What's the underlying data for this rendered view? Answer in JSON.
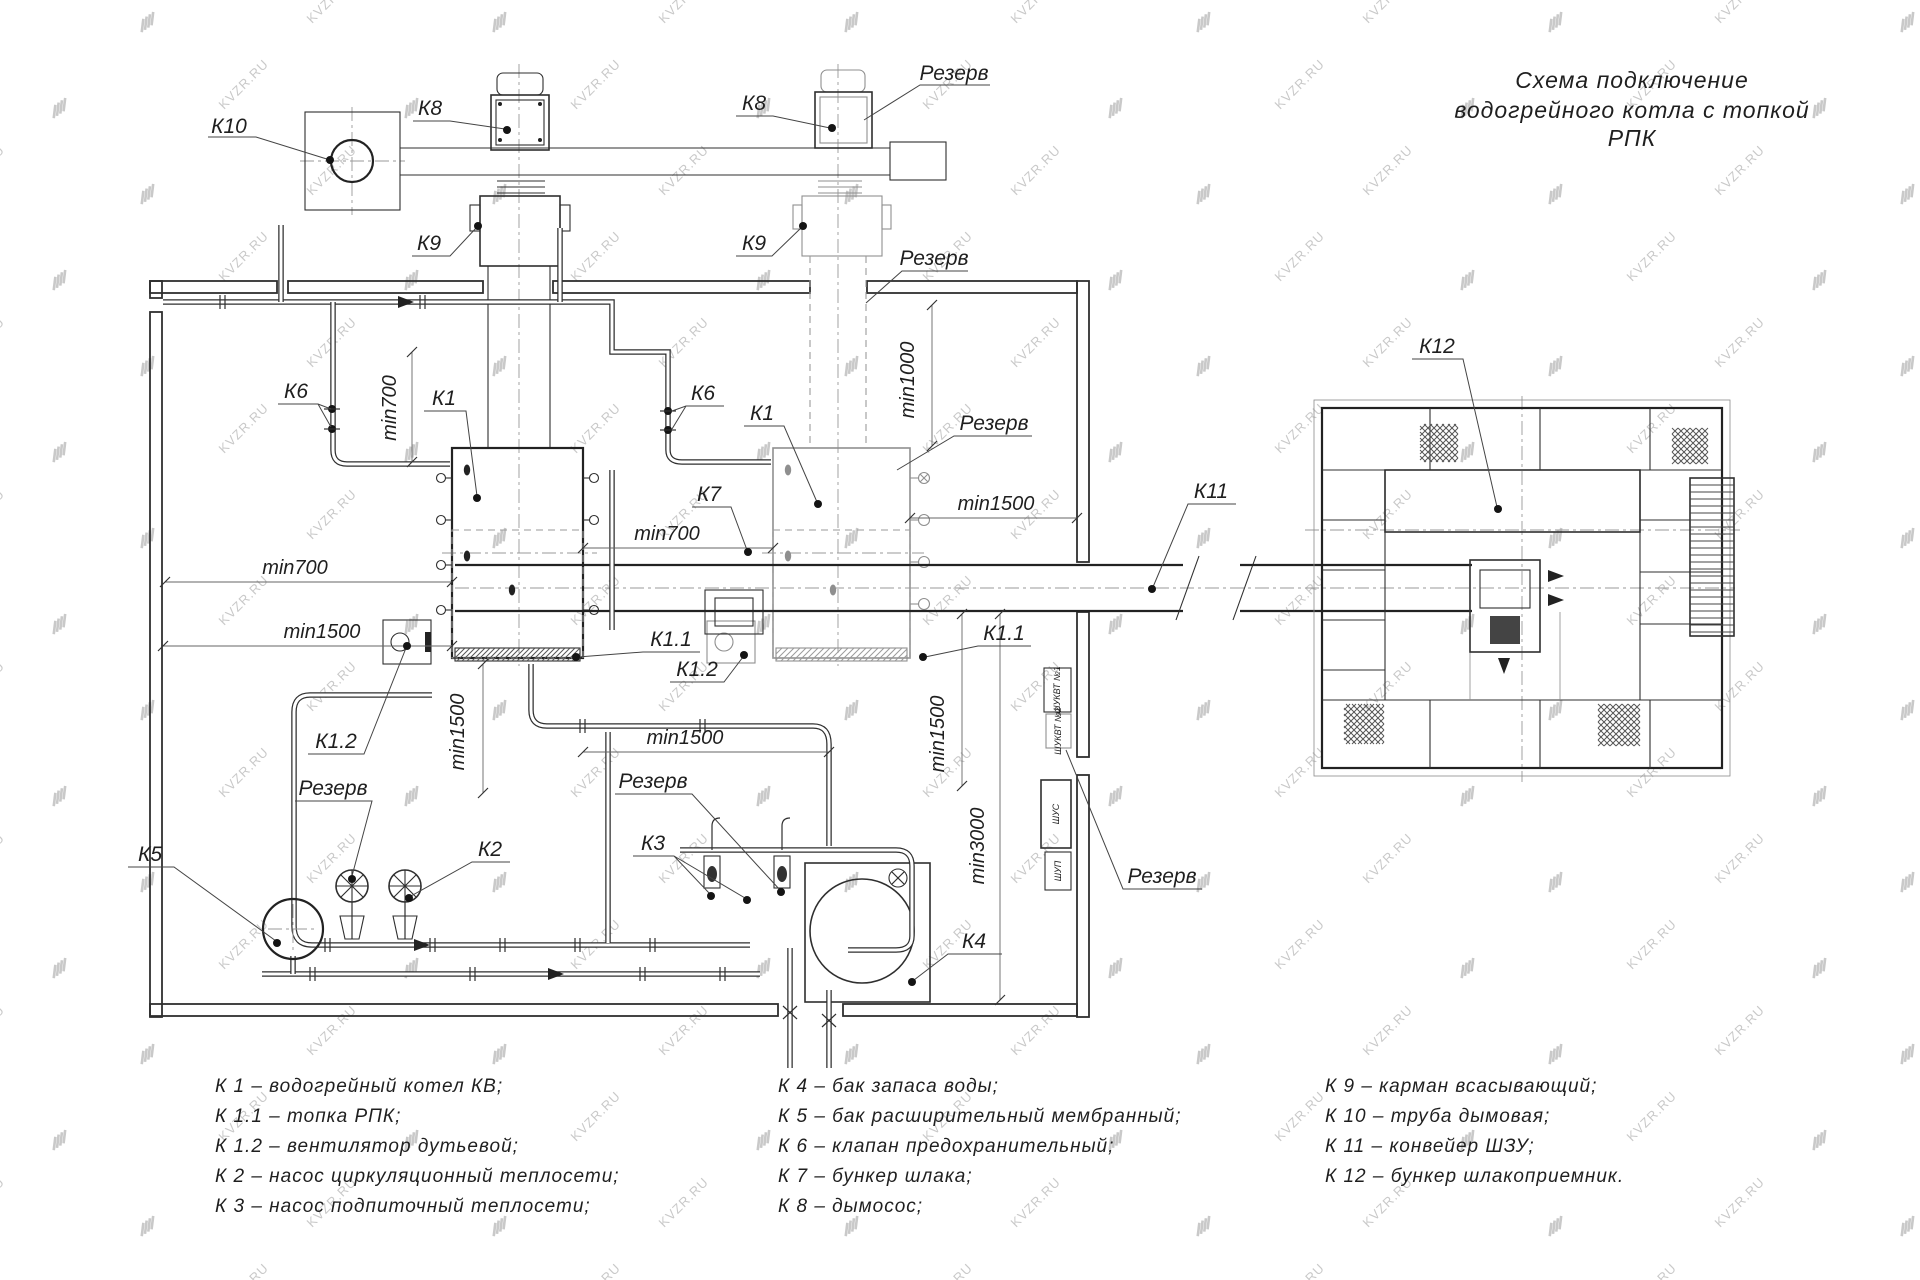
{
  "title": {
    "line1": "Схема подключение",
    "line2": "водогрейного котла с топкой",
    "line3": "РПК"
  },
  "watermark": {
    "text": "KVZR.RU"
  },
  "labels": {
    "k1": "К1",
    "k1_1": "К1.1",
    "k1_2": "К1.2",
    "k2": "К2",
    "k3": "К3",
    "k4": "К4",
    "k5": "К5",
    "k6": "К6",
    "k7": "К7",
    "k8": "К8",
    "k9": "К9",
    "k10": "К10",
    "k11": "К11",
    "k12": "К12",
    "reserve": "Резерв"
  },
  "dims": {
    "d700": "min700",
    "d1000": "min1000",
    "d1500": "min1500",
    "d3000": "min3000"
  },
  "cabinets": [
    "ШУКВТ №1",
    "ШУКВТ №2",
    "ШУС",
    "ШУП"
  ],
  "legend": {
    "col1": [
      "К 1  –  водогрейный котел КВ;",
      "К 1.1  –  топка РПК;",
      "К 1.2  –  вентилятор дутьевой;",
      "К 2  –  насос циркуляционный теплосети;",
      "К 3  –  насос подпиточный теплосети;"
    ],
    "col2": [
      "К 4  –  бак запаса воды;",
      "К 5  –  бак расширительный мембранный;",
      "К 6  –  клапан предохранительный;",
      "К 7  –  бункер шлака;",
      "К 8  –  дымосос;"
    ],
    "col3": [
      "К 9  –  карман всасывающий;",
      "К 10  –  труба дымовая;",
      "К 11  –  конвейер ШЗУ;",
      "К 12  –  бункер шлакоприемник."
    ]
  }
}
